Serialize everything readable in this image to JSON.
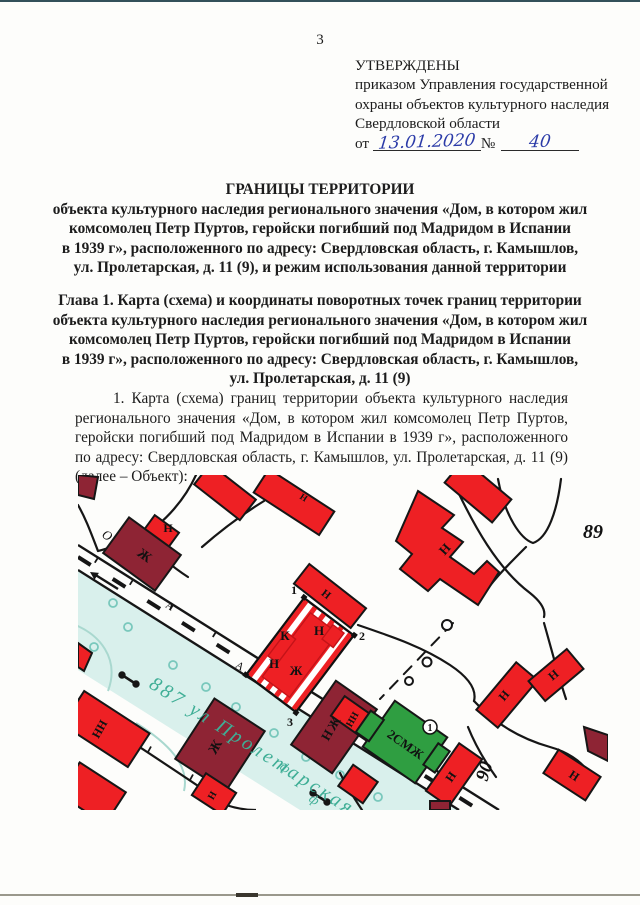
{
  "page": {
    "number": "3"
  },
  "approval": {
    "lines": [
      "УТВЕРЖДЕНЫ",
      "приказом Управления государственной",
      "охраны объектов культурного наследия",
      "Свердловской области"
    ],
    "date_label": "от",
    "date_value": "13.01.2020",
    "no_label": "№",
    "no_value": "40"
  },
  "title": {
    "heading": "ГРАНИЦЫ ТЕРРИТОРИИ",
    "lines": [
      "объекта культурного наследия регионального значения «Дом, в котором жил",
      "комсомолец Петр Пуртов, геройски погибший под Мадридом в Испании",
      "в 1939 г», расположенного по адресу: Свердловская область, г. Камышлов,",
      "ул. Пролетарская, д. 11 (9), и режим использования данной территории"
    ]
  },
  "chapter": {
    "lines": [
      "Глава 1. Карта (схема) и координаты поворотных точек границ территории",
      "объекта культурного наследия регионального значения «Дом, в котором жил",
      "комсомолец Петр Пуртов, геройски погибший под Мадридом в Испании",
      "в 1939 г», расположенного по адресу: Свердловская область, г. Камышлов,",
      "ул. Пролетарская, д. 11 (9)"
    ]
  },
  "body_paragraph": "1. Карта (схема) границ территории объекта культурного наследия регионального значения «Дом, в котором жил комсомолец Петр Пуртов, геройски погибший под Мадридом в Испании в 1939 г», расположенного по адресу: Свердловская область, г. Камышлов, ул. Пролетарская, д. 11 (9) (далее – Объект):",
  "map": {
    "street_label": "887 ул Пролетарская",
    "block_numbers": {
      "b89": "89",
      "b90": "90"
    },
    "road_letters": {
      "o": "О",
      "a1": "А",
      "a2": "А"
    },
    "corner_points": {
      "p1": "1",
      "p2": "2",
      "p3": "3"
    },
    "green_building_number": "1",
    "letters": {
      "zh": "Ж",
      "n": "Н",
      "nn": "НН",
      "nzh": "НЖ",
      "k": "К",
      "smzh": "2СМЖ"
    },
    "colors": {
      "building_red": "#ee2024",
      "building_maroon": "#8e2434",
      "building_green": "#2f9e41",
      "street_fill": "#d9f0ec",
      "street_text": "#3fae96",
      "line_black": "#161616"
    }
  }
}
